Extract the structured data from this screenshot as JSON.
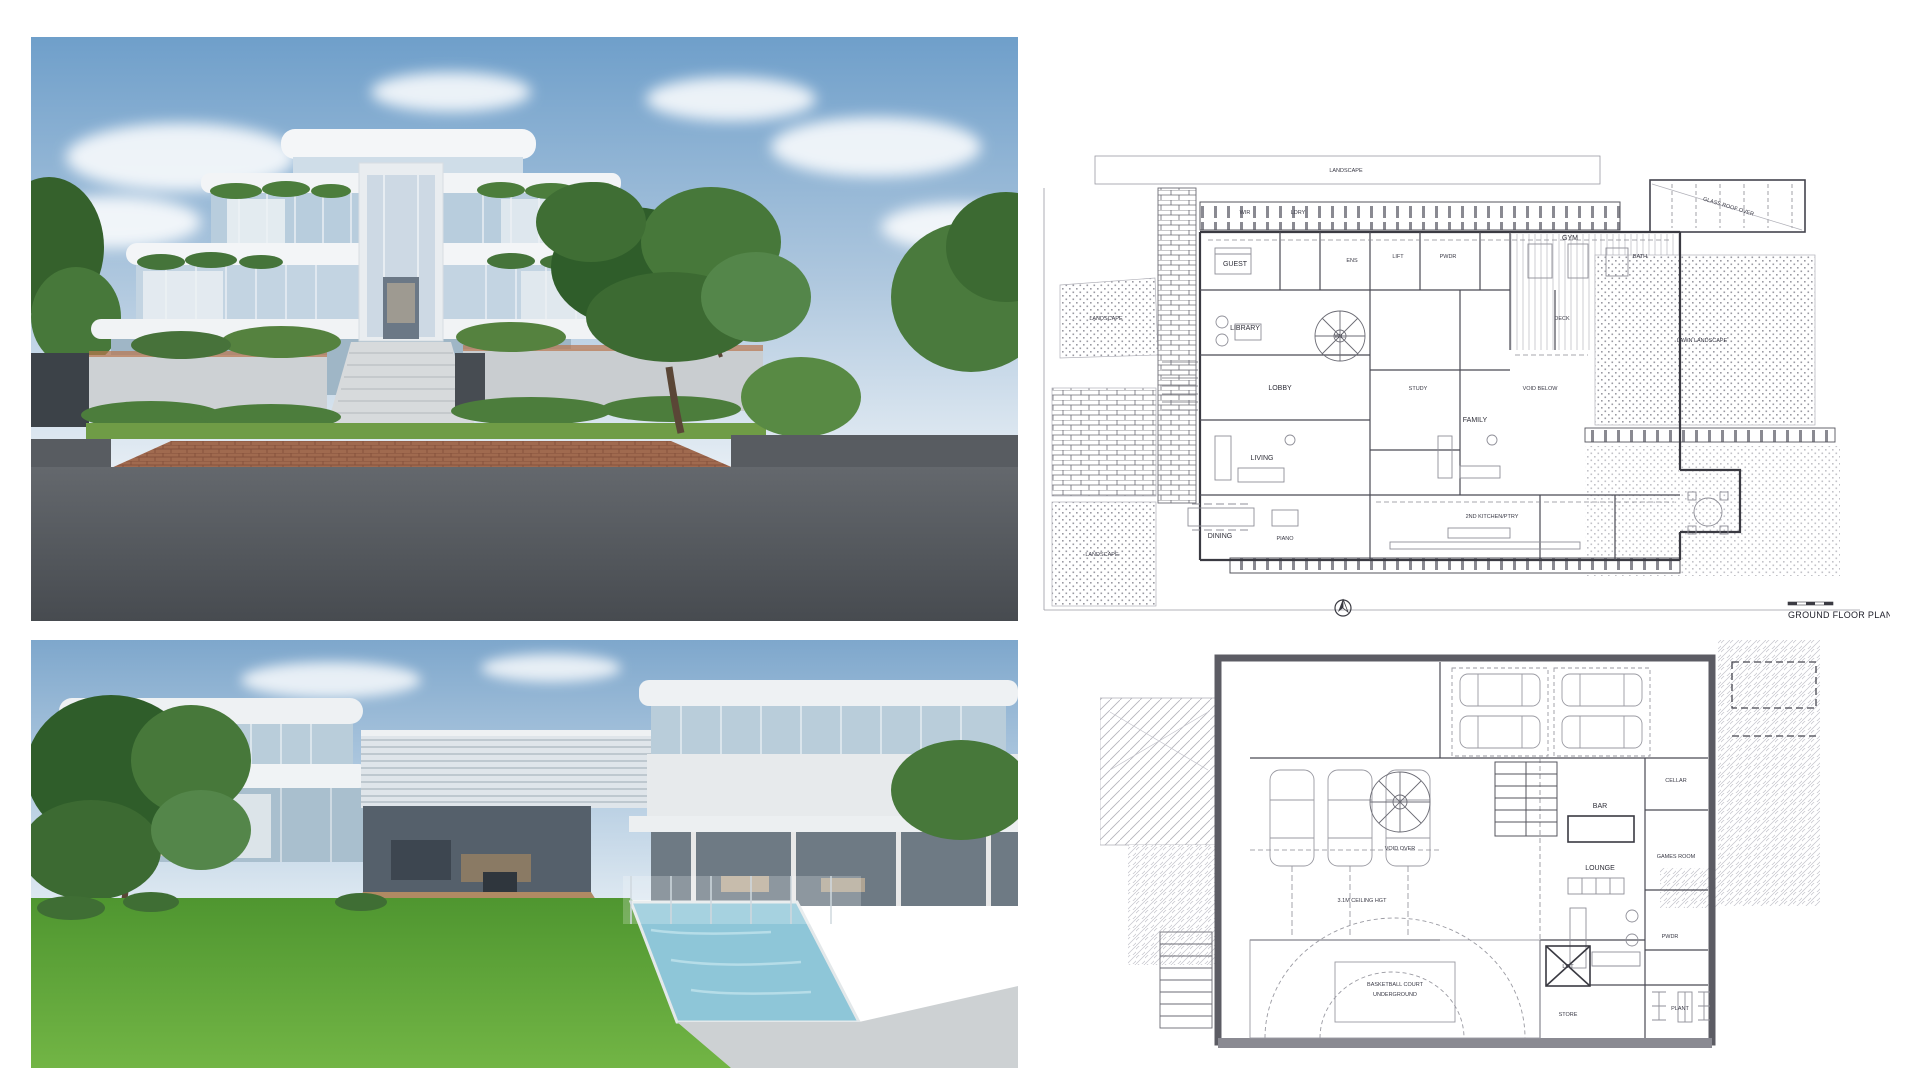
{
  "sheet": {
    "background": "#ffffff"
  },
  "renders": {
    "front": {
      "palette": {
        "sky": "#6f9fca",
        "building": "#f2f4f6",
        "glass": "#b8cddd",
        "foliage": "#3f6e34",
        "hedge": "#4c7d3c",
        "road": "#53575c",
        "paving": "#a06a4f",
        "fence": "#cdd1d4"
      }
    },
    "rear": {
      "palette": {
        "sky": "#8fb3d4",
        "building": "#eef1f3",
        "glass": "#b9cdda",
        "lawn": "#55a033",
        "pool": "#8ec6d8",
        "deck": "#b5927a",
        "foliage": "#3f6e34",
        "patio": "#6e7a84"
      }
    }
  },
  "plans": {
    "ground": {
      "title": "GROUND FLOOR PLAN",
      "labels": [
        "LANDSCAPE",
        "LANDSCAPE",
        "LANDSCAPE",
        "WIR",
        "LDRY",
        "GUEST",
        "ENS",
        "LIFT",
        "PWDR",
        "GYM",
        "BATH",
        "LIBRARY",
        "STUDY",
        "LOBBY",
        "VOID BELOW",
        "DECK",
        "LAWN LANDSCAPE",
        "LIVING",
        "FAMILY",
        "DINING",
        "PIANO",
        "2ND KITCHEN/PTRY",
        "GLASS ROOF OVER",
        "W.L."
      ]
    },
    "basement": {
      "labels": [
        "VOID OVER",
        "BAR",
        "CELLAR",
        "LOUNGE",
        "GAMES ROOM",
        "PWDR",
        "3.1M CEILING HGT",
        "BASKETBALL COURT",
        "UNDERGROUND",
        "LIFT",
        "STORE",
        "PLANT"
      ]
    }
  }
}
